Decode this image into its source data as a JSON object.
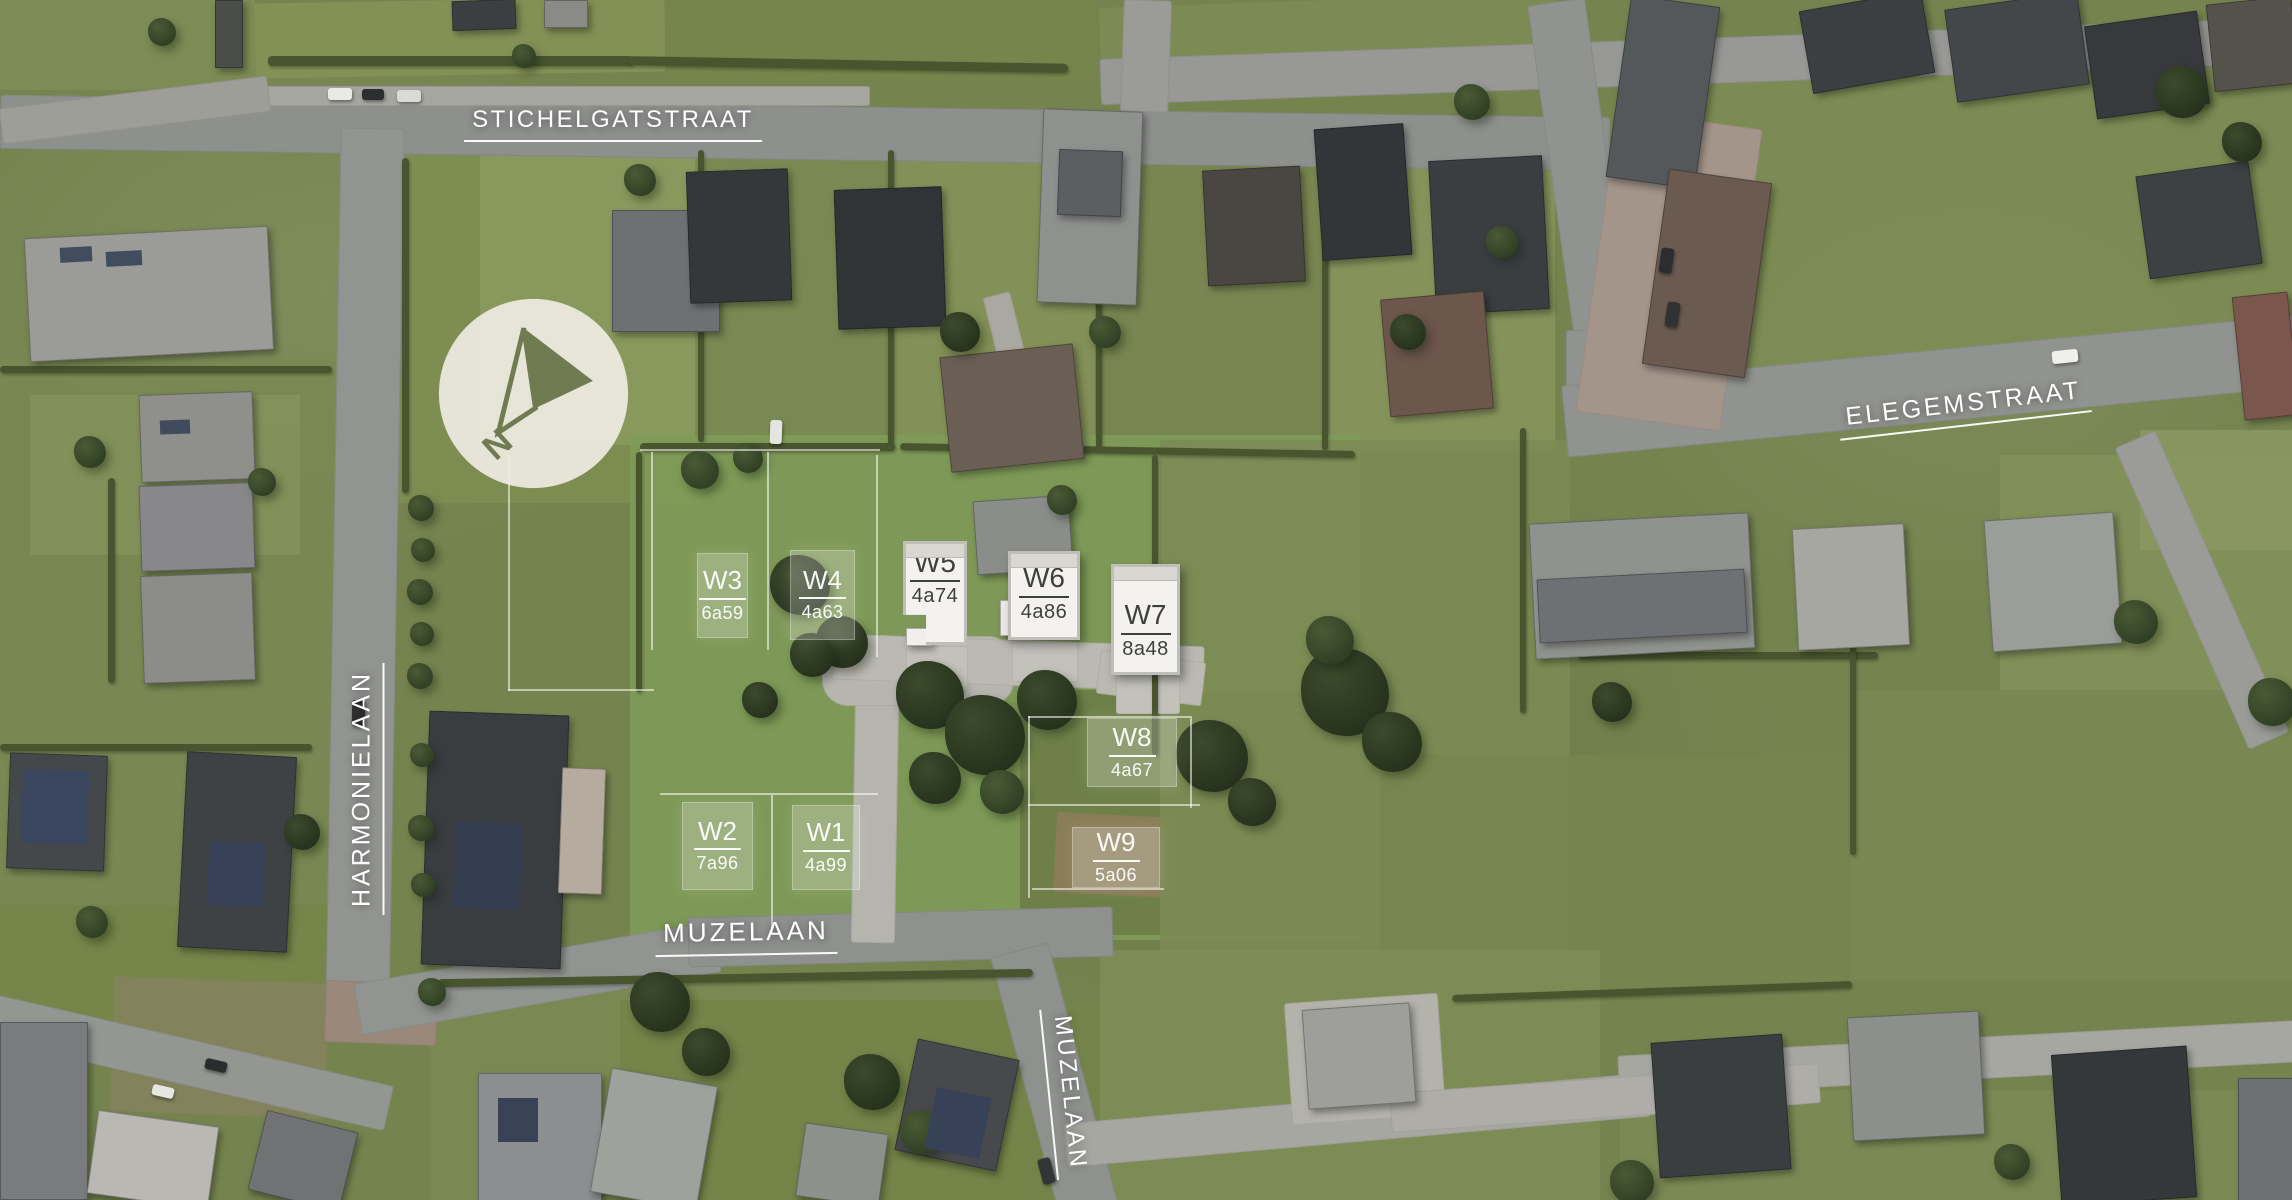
{
  "streets": {
    "stichelgatstraat": {
      "label": "STICHELGATSTRAAT"
    },
    "elegemstraat": {
      "label": "ELEGEMSTRAAT"
    },
    "harmonielaan": {
      "label": "HARMONIELAAN"
    },
    "muzelaan_horizontal": {
      "label": "MUZELAAN"
    },
    "muzelaan_vertical": {
      "label": "MUZELAAN"
    }
  },
  "compass": {
    "north_label": "N"
  },
  "plots": [
    {
      "id": "W1",
      "area": "4a99",
      "marker": "ghost-overlay"
    },
    {
      "id": "W2",
      "area": "7a96",
      "marker": "ghost-overlay"
    },
    {
      "id": "W3",
      "area": "6a59",
      "marker": "ghost-overlay"
    },
    {
      "id": "W4",
      "area": "4a63",
      "marker": "ghost-overlay"
    },
    {
      "id": "W5",
      "area": "4a74",
      "marker": "building-volume"
    },
    {
      "id": "W6",
      "area": "4a86",
      "marker": "building-volume"
    },
    {
      "id": "W7",
      "area": "8a48",
      "marker": "building-volume"
    },
    {
      "id": "W8",
      "area": "4a67",
      "marker": "ghost-overlay"
    },
    {
      "id": "W9",
      "area": "5a06",
      "marker": "ghost-overlay"
    }
  ],
  "colors": {
    "street_label_text": "#ffffff",
    "building_fill": "#f3f2ee",
    "building_roof_edge": "#c0beb8",
    "building_ink": "#3f3f3f",
    "ghost_overlay": "rgba(255,255,255,0.24)",
    "compass_circle": "#edebe1",
    "compass_arrow": "#707b52",
    "grass_base": "#75844f",
    "road_gray": "#8e908e"
  }
}
